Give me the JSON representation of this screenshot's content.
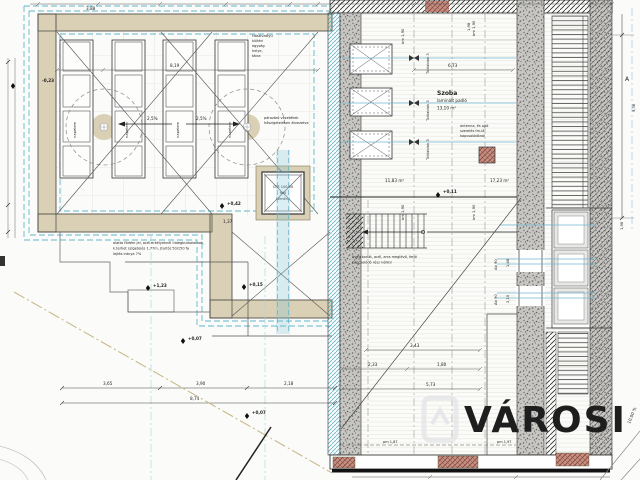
{
  "colors": {
    "beige": "#d9d0b5",
    "beige_edge": "#8f8668",
    "cyan": "#62b5cb",
    "blue_line": "#6fb7d2",
    "ink": "#2f2f2f",
    "tan_boundary": "#c9b98c",
    "brick": "#9c5a4c"
  },
  "watermark": {
    "brand": "VÁROSI",
    "logo": "house-logo"
  },
  "room": {
    "name": "Szoba",
    "floor": "laminált padló",
    "area": "13,10 m²",
    "area_left_zone": "11,83 m²",
    "area_right_zone": "17,23 m²"
  },
  "labels": {
    "solar_panel": "napelem",
    "sliding_window": "Tolóablak 3",
    "clear_height": "bm 1,90",
    "window_mark": "Ab 90",
    "parapet_1": "pm 1,87",
    "parapet_2": "pm 1,97",
    "section_marker": "A",
    "ramp_slope": "10.00 %",
    "roof_slope_left": "2,5%",
    "roof_slope_right": "2,5%"
  },
  "elevations": {
    "e1": "+0,42",
    "e2": "+0,11",
    "e3": "+1,23",
    "e4": "+0,15",
    "e5": "+0,07",
    "e6": "+0,07",
    "e7": "-0,23"
  },
  "dimensions": {
    "d365": "3,65",
    "d390": "3,90",
    "d218": "2,18",
    "d874": "8,74",
    "d673": "6,73",
    "d343": "3,43",
    "d233": "2,33",
    "d180": "1,80",
    "d573": "5,73",
    "d137": "1,37",
    "d819": "8,19",
    "d198": "1,98",
    "d936": "9,36",
    "d388": "3,88",
    "d148": "1,48",
    "d210": "2,10"
  },
  "notes": {
    "chimney_1": "CPE 100/50",
    "chimney_2": "falú",
    "chimney_3": "kémény",
    "heatpump_1": "Hőszivattyú",
    "heatpump_2": "kültéri",
    "heatpump_3": "egység",
    "heatpump_4": "helye,",
    "heatpump_5": "tálca",
    "vapor_1": "párazáró vezetékek",
    "vapor_2": "hőszigetelésen átvezetve",
    "terrace_1": "alatta födém jel, acél erkélyeknél hidegburkolatnak,",
    "terrace_2": "k.terhet szigetelés 1,77m, (tartó) 50/150 fa",
    "terrace_3": "lejtés iránya 7%",
    "stair_1": "üveg korlát, acél, arra meglévő, fenti",
    "stair_2": "kapcsolódó rész nélkül",
    "antenna_1": "antenna, és ajtó",
    "antenna_2": "szerelés fm-lé",
    "antenna_3": "kapcsolódónál"
  }
}
